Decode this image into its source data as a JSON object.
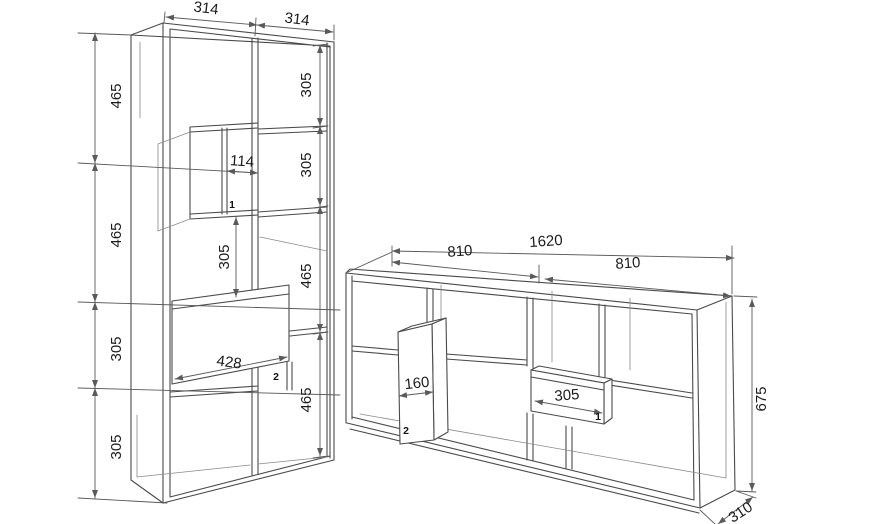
{
  "tall_unit": {
    "top_widths": [
      "314",
      "314"
    ],
    "left_heights": [
      "465",
      "465",
      "305",
      "305"
    ],
    "right_heights": [
      "305",
      "305",
      "465",
      "465"
    ],
    "niche_width": "114",
    "niche_part": "1",
    "center_height": "305",
    "drawer_width": "428",
    "drawer_part": "2"
  },
  "sideboard": {
    "total_width": "1620",
    "half_widths": [
      "810",
      "810"
    ],
    "height": "675",
    "depth": "310",
    "niche_width": "160",
    "niche_part": "2",
    "drawer_width": "305",
    "drawer_part": "1"
  },
  "colors": {
    "object_line": "#4a4a4a",
    "dimension_line": "#5a5a5a",
    "label_text": "#1c1c1c",
    "background": "#ffffff"
  }
}
